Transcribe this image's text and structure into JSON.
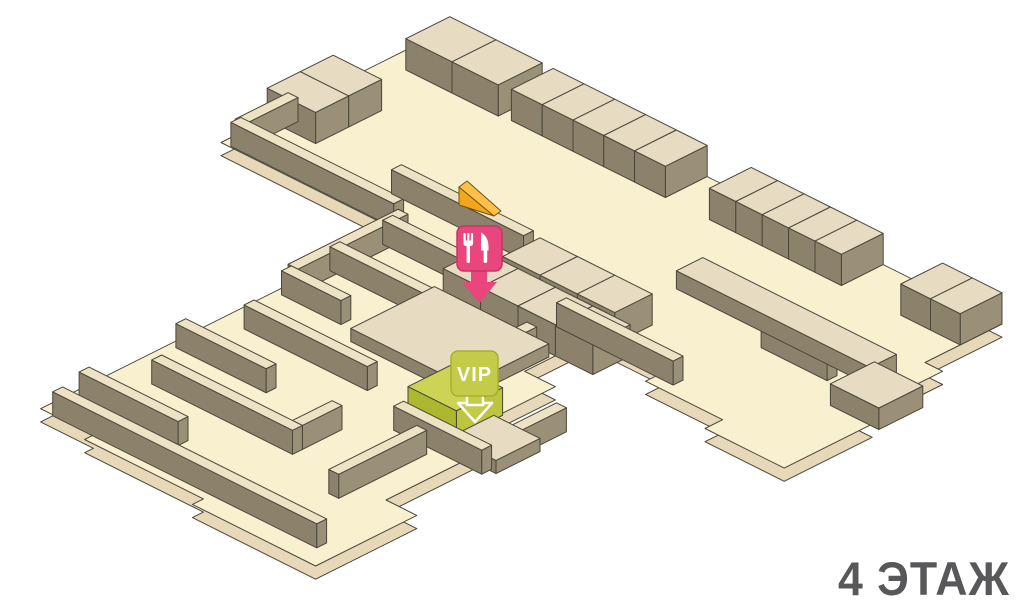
{
  "title": {
    "text": "4 ЭТАЖ"
  },
  "markers": {
    "food_court": {
      "icon": "fork-knife-icon",
      "color": "#e8467d",
      "border": "#c93364",
      "box": {
        "x": 457,
        "y": 226,
        "w": 45,
        "h": 45,
        "r": 7
      },
      "arrow_tip": [
        479,
        303
      ]
    },
    "vip": {
      "label": "VIP",
      "color": "#c3cb49",
      "border": "#a8b12f",
      "box": {
        "x": 451,
        "y": 351,
        "w": 47,
        "h": 45,
        "r": 7
      },
      "arrow_tip": [
        475,
        422
      ]
    },
    "escalator": {
      "icon": "escalator-wedge-icon",
      "color_top": "#ffc04a",
      "color_front": "#f2a71b",
      "outline": "#6b5312"
    }
  },
  "colors": {
    "floor": "#f8f0cf",
    "slab": "#e6d8b8",
    "outline": "#4a463a",
    "block_top": "#e7dbc2",
    "block_side_l": "#8c826b",
    "block_side_r": "#9a8f77",
    "wall_top": "#ede2c4",
    "lime_top": "#cdd455",
    "lime_side_l": "#aeb82e",
    "lime_side_r": "#bcc53d",
    "title_color": "#58585a",
    "pink": "#e8467d",
    "lime": "#c3cb49"
  },
  "scene": {
    "iso": {
      "ox": 430,
      "oy": 38,
      "c": 22,
      "z": 24,
      "slab_drop": 0.55
    },
    "floor_outline": [
      [
        0,
        0
      ],
      [
        26,
        0
      ],
      [
        26,
        3.5
      ],
      [
        26.8,
        3.5
      ],
      [
        26.8,
        7.5
      ],
      [
        27.6,
        7.5
      ],
      [
        27.6,
        11.5
      ],
      [
        24,
        11.5
      ],
      [
        24,
        10.7
      ],
      [
        20.5,
        10.7
      ],
      [
        20.5,
        9.9
      ],
      [
        17.3,
        9.9
      ],
      [
        17.3,
        13
      ],
      [
        18.7,
        13
      ],
      [
        18.7,
        17.5
      ],
      [
        20,
        17.5
      ],
      [
        20,
        22
      ],
      [
        21.4,
        22
      ],
      [
        21.4,
        26.6
      ],
      [
        15.8,
        26.6
      ],
      [
        15.8,
        26.1
      ],
      [
        10.4,
        26.1
      ],
      [
        10.4,
        25.7
      ],
      [
        8,
        25.7
      ],
      [
        8,
        9.5
      ],
      [
        0,
        9.5
      ]
    ],
    "blocks": [
      {
        "n": "kiosk-block",
        "x0": 0.9,
        "y0": 0,
        "x1": 3,
        "y1": 2,
        "z": 1.3,
        "k": "kiosk"
      },
      {
        "n": "kiosk-block",
        "x0": 3,
        "y0": 0,
        "x1": 5.1,
        "y1": 2,
        "z": 1.3,
        "k": "kiosk"
      },
      {
        "n": "kiosk-block",
        "x0": 0,
        "y0": 4.4,
        "x1": 2.2,
        "y1": 5.9,
        "z": 1.3,
        "k": "kiosk"
      },
      {
        "n": "kiosk-block",
        "x0": 0,
        "y0": 5.9,
        "x1": 2.2,
        "y1": 7.4,
        "z": 1.3,
        "k": "kiosk"
      },
      {
        "n": "kiosk-block",
        "x0": 5.6,
        "y0": 0,
        "x1": 7,
        "y1": 1.9,
        "z": 1.3,
        "k": "kiosk"
      },
      {
        "n": "kiosk-block",
        "x0": 7,
        "y0": 0,
        "x1": 8.4,
        "y1": 1.9,
        "z": 1.3,
        "k": "kiosk"
      },
      {
        "n": "kiosk-block",
        "x0": 8.4,
        "y0": 0,
        "x1": 9.8,
        "y1": 1.9,
        "z": 1.3,
        "k": "kiosk"
      },
      {
        "n": "kiosk-block",
        "x0": 9.8,
        "y0": 0,
        "x1": 11.2,
        "y1": 1.9,
        "z": 1.3,
        "k": "kiosk"
      },
      {
        "n": "kiosk-block",
        "x0": 11.2,
        "y0": 0,
        "x1": 12.6,
        "y1": 1.9,
        "z": 1.3,
        "k": "kiosk"
      },
      {
        "n": "kiosk-block",
        "x0": 14.6,
        "y0": 0,
        "x1": 15.8,
        "y1": 1.9,
        "z": 1.3,
        "k": "kiosk"
      },
      {
        "n": "kiosk-block",
        "x0": 15.8,
        "y0": 0,
        "x1": 17,
        "y1": 1.9,
        "z": 1.3,
        "k": "kiosk"
      },
      {
        "n": "kiosk-block",
        "x0": 17,
        "y0": 0,
        "x1": 18.2,
        "y1": 1.9,
        "z": 1.3,
        "k": "kiosk"
      },
      {
        "n": "kiosk-block",
        "x0": 18.2,
        "y0": 0,
        "x1": 19.4,
        "y1": 1.9,
        "z": 1.3,
        "k": "kiosk"
      },
      {
        "n": "kiosk-block",
        "x0": 19.4,
        "y0": 0,
        "x1": 20.6,
        "y1": 1.9,
        "z": 1.3,
        "k": "kiosk"
      },
      {
        "n": "kiosk-block",
        "x0": 23.3,
        "y0": 0,
        "x1": 24.65,
        "y1": 1.9,
        "z": 1.3,
        "k": "kiosk"
      },
      {
        "n": "kiosk-block",
        "x0": 24.65,
        "y0": 0,
        "x1": 26,
        "y1": 1.9,
        "z": 1.3,
        "k": "kiosk"
      },
      {
        "n": "kiosk-block",
        "x0": 13,
        "y0": 8,
        "x1": 14.7,
        "y1": 9.7,
        "z": 1.3,
        "k": "kiosk"
      },
      {
        "n": "kiosk-block",
        "x0": 14.7,
        "y0": 8,
        "x1": 16.4,
        "y1": 9.7,
        "z": 1.3,
        "k": "kiosk"
      },
      {
        "n": "kiosk-block",
        "x0": 16.4,
        "y0": 8,
        "x1": 18.1,
        "y1": 9.7,
        "z": 1.3,
        "k": "kiosk"
      },
      {
        "n": "kiosk-block",
        "x0": 12.2,
        "y0": 9.9,
        "x1": 13.9,
        "y1": 11.6,
        "z": 1.3,
        "k": "kiosk"
      },
      {
        "n": "kiosk-block",
        "x0": 13.9,
        "y0": 9.9,
        "x1": 15.6,
        "y1": 11.6,
        "z": 1.3,
        "k": "kiosk"
      },
      {
        "n": "kiosk-block",
        "x0": 15.6,
        "y0": 9.9,
        "x1": 17.3,
        "y1": 11.6,
        "z": 1.3,
        "k": "kiosk"
      },
      {
        "n": "kiosk-block",
        "x0": 17.3,
        "y0": 9.9,
        "x1": 19,
        "y1": 11.6,
        "z": 1.3,
        "k": "kiosk"
      },
      {
        "n": "retail-band",
        "x0": 17,
        "y0": 4.6,
        "x1": 25.8,
        "y1": 5.8,
        "z": 0.75,
        "k": "kiosk"
      },
      {
        "n": "kiosk-block",
        "x0": 25.8,
        "y0": 5.6,
        "x1": 28,
        "y1": 7.6,
        "z": 0.9,
        "k": "kiosk"
      },
      {
        "n": "stage-platform",
        "x0": 12,
        "y0": 11.8,
        "x1": 17.2,
        "y1": 15.6,
        "z": 0.55,
        "k": "kiosk"
      },
      {
        "n": "low-platform",
        "x0": 19.2,
        "y0": 16.3,
        "x1": 21.3,
        "y1": 18.3,
        "z": 0.55,
        "k": "kiosk"
      },
      {
        "n": "vip-room-block",
        "x0": 16.6,
        "y0": 15.5,
        "x1": 18.8,
        "y1": 17.6,
        "z": 1.15,
        "k": "lime"
      }
    ],
    "walls": [
      {
        "x0": 0.35,
        "y0": 6.8,
        "x1": 0.8,
        "y1": 9.2
      },
      {
        "x0": 0.4,
        "y0": 9.0,
        "x1": 7.8,
        "y1": 9.45
      },
      {
        "x0": 6.2,
        "y0": 7.5,
        "x1": 12.2,
        "y1": 7.95
      },
      {
        "x0": 8.3,
        "y0": 10.0,
        "x1": 15,
        "y1": 10.45
      },
      {
        "x0": 16,
        "y0": 9.8,
        "x1": 21.3,
        "y1": 10.25
      },
      {
        "x0": 8.15,
        "y0": 9.6,
        "x1": 8.6,
        "y1": 14.6
      },
      {
        "x0": 21.6,
        "y0": 6.1,
        "x1": 24.6,
        "y1": 6.55
      },
      {
        "x0": 8.3,
        "y0": 12.4,
        "x1": 13.2,
        "y1": 12.85
      },
      {
        "x0": 12.75,
        "y0": 12.85,
        "x1": 13.2,
        "y1": 14.4
      },
      {
        "x0": 8.3,
        "y0": 14.6,
        "x1": 11,
        "y1": 15.05
      },
      {
        "x0": 16.2,
        "y0": 11.8,
        "x1": 16.65,
        "y1": 15.2
      },
      {
        "x0": 9,
        "y0": 17,
        "x1": 14.6,
        "y1": 17.45
      },
      {
        "x0": 8.3,
        "y0": 19.4,
        "x1": 12.4,
        "y1": 19.85
      },
      {
        "x0": 9.4,
        "y0": 21.6,
        "x1": 15.8,
        "y1": 22.05
      },
      {
        "x0": 15.35,
        "y0": 19.8,
        "x1": 15.8,
        "y1": 21.6
      },
      {
        "x0": 8.3,
        "y0": 23.8,
        "x1": 12.8,
        "y1": 24.25
      },
      {
        "x0": 8.6,
        "y0": 25.3,
        "x1": 20.6,
        "y1": 25.75
      },
      {
        "x0": 18.4,
        "y0": 19,
        "x1": 18.85,
        "y1": 23
      },
      {
        "x0": 17,
        "y0": 18.2,
        "x1": 21,
        "y1": 18.65
      },
      {
        "x0": 20.55,
        "y0": 14.8,
        "x1": 21,
        "y1": 18.2
      }
    ]
  }
}
